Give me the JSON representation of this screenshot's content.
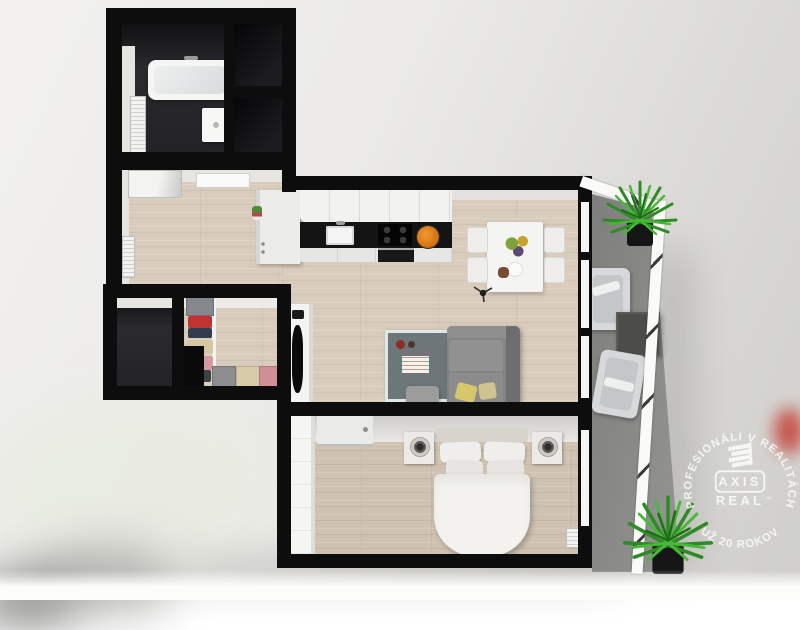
{
  "watermark": {
    "arc_top": "PROFESIONÁLI V REALITÁCH",
    "arc_bottom": "UŽ 20 ROKOV",
    "brand_top": "AXIS",
    "brand_bottom": "REAL",
    "trademark": "™"
  },
  "palette": {
    "wall_black": "#0d0d0d",
    "wood_floor": "#d9ccbc",
    "bedroom_floor": "#cfc2b1",
    "dark_tile": "#232327",
    "balcony_floor": "#8d8d8a",
    "sofa_gray": "#848484",
    "pillow_yellow": "#d8c66a",
    "fruit_orange": "#e2801c",
    "plant_green": "#2e8b25",
    "stamp_white": "#ffffff"
  }
}
